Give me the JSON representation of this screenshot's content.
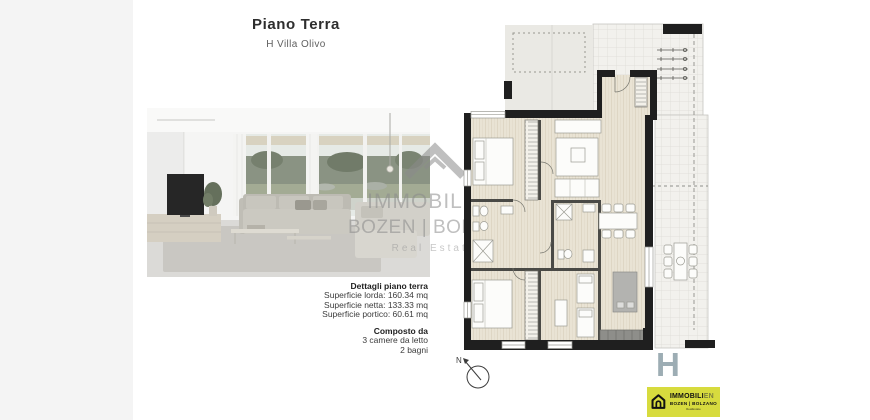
{
  "header": {
    "title": "Piano Terra",
    "subtitle": "H Villa Olivo"
  },
  "details": {
    "heading": "Dettagli piano terra",
    "rows": [
      "Superficie lorda: 160.34 mq",
      "Superficie netta: 133.33 mq",
      "Superficie portico: 60.61 mq"
    ],
    "composition_heading": "Composto da",
    "composition_rows": [
      "3 camere da letto",
      "2 bagni"
    ]
  },
  "watermark": {
    "brand": "IMMOBILIEN",
    "location": "BOZEN | BOLZANO",
    "tagline": "Real Estate"
  },
  "floor_plan": {
    "compass_label": "N",
    "unit_letter": "H"
  },
  "footer_logo": {
    "brand_main": "IMMOBILI",
    "brand_suffix": "EN",
    "location": "BOZEN | BOLZANO",
    "tagline": "RealEstate",
    "background": "#d7db3e"
  },
  "colors": {
    "wall": "#1f1f1f",
    "wood_floor": "#e9e3d4",
    "tile_floor": "#f2f1ed",
    "portico": "#eae9e4",
    "unit_letter": "#9dadb4",
    "logo_background": "#d7db3e"
  }
}
